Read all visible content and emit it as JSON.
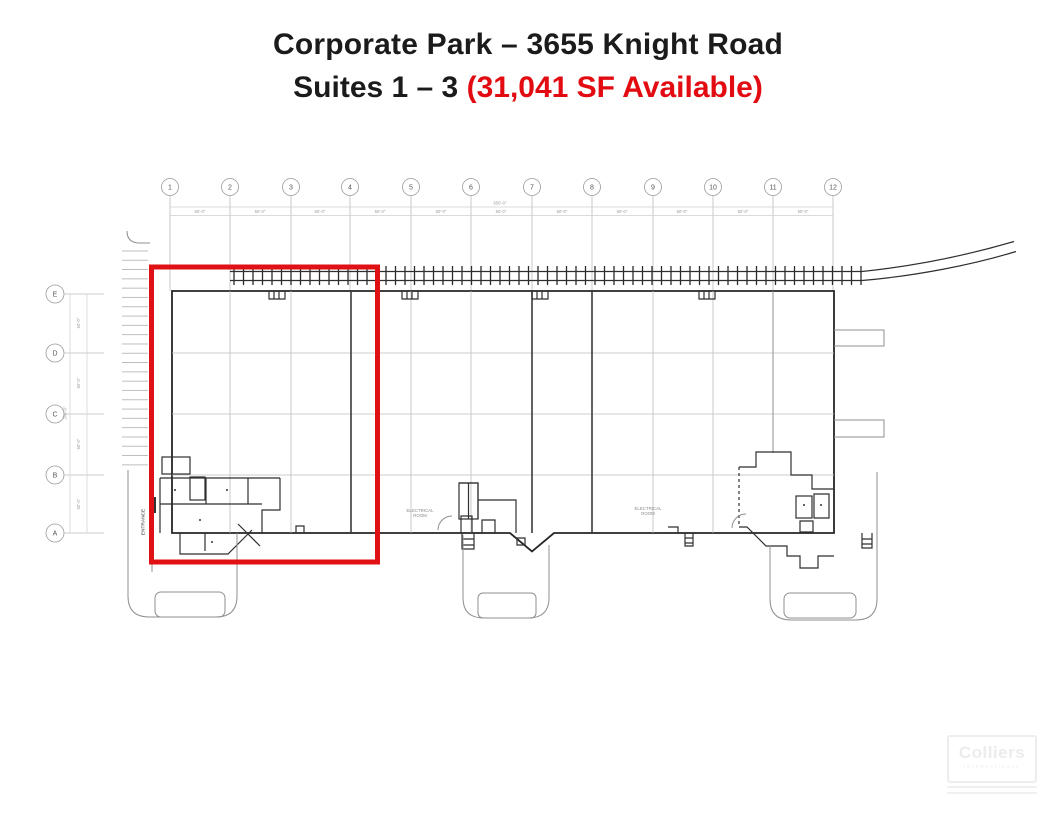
{
  "title": {
    "line1": "Corporate Park – 3655 Knight Road",
    "line2_black": "Suites 1 – 3 ",
    "line2_red": "(31,041 SF Available)"
  },
  "colors": {
    "accent_red": "#E30B12",
    "highlight_box_red": "#E01114",
    "plan_dark_line": "#2F2F2F",
    "plan_light_line": "#BDBDBD"
  },
  "plan": {
    "column_labels": [
      "1",
      "2",
      "3",
      "4",
      "5",
      "6",
      "7",
      "8",
      "9",
      "10",
      "11",
      "12"
    ],
    "row_labels": [
      "E",
      "D",
      "C",
      "B",
      "A"
    ],
    "dims": {
      "bay": "50'-0\"",
      "overall_top": "650'-0\"",
      "row": "60'-0\"",
      "overall_left": "240'-0\""
    },
    "entrance_label": "ENTRANCE",
    "room_label_left_line1": "ELECTRICAL",
    "room_label_left_line2": "ROOM",
    "room_label_right_line1": "ELECTRICAL",
    "room_label_right_line2": "ROOM"
  },
  "watermark": {
    "brand": "Colliers",
    "sub": "INTERNATIONAL"
  }
}
